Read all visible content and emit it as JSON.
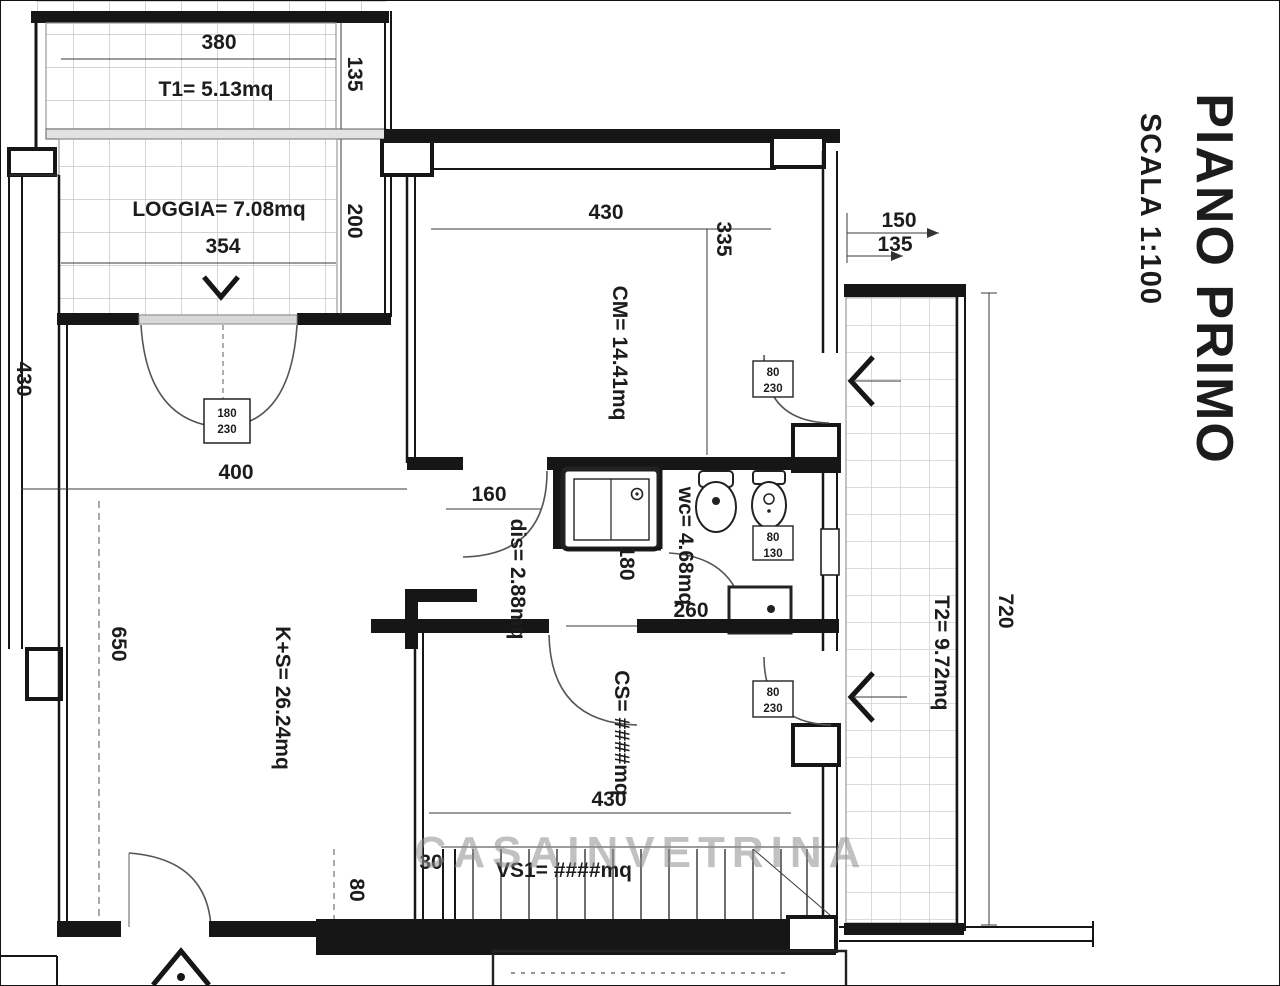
{
  "header": {
    "title": "PIANO PRIMO",
    "scale": "SCALA 1:100"
  },
  "watermark": "CASAINVETRINA",
  "rooms": {
    "t1": "T1= 5.13mq",
    "loggia": "LOGGIA= 7.08mq",
    "cm": "CM= 14.41mq",
    "dis": "dis= 2.88mq",
    "wc": "wc= 4.68mq",
    "ks": "K+S= 26.24mq",
    "cs": "CS= ####mq",
    "vs1": "VS1= ####mq",
    "t2": "T2= 9.72mq"
  },
  "dims": {
    "top_380": "380",
    "top_135": "135",
    "loggia_354": "354",
    "loggia_200": "200",
    "left_430": "430",
    "cm_430": "430",
    "cm_335": "335",
    "right_150": "150",
    "right_135": "135",
    "ks_400": "400",
    "ks_650": "650",
    "dis_160": "160",
    "shower_180": "180",
    "wc_260": "260",
    "cs_430": "430",
    "stair_30": "30",
    "stair_80": "80",
    "t2_720": "720"
  },
  "openings": {
    "ks_door": [
      "180",
      "230"
    ],
    "cm_door": [
      "80",
      "230"
    ],
    "wc_window": [
      "80",
      "130"
    ],
    "cs_door": [
      "80",
      "230"
    ]
  }
}
